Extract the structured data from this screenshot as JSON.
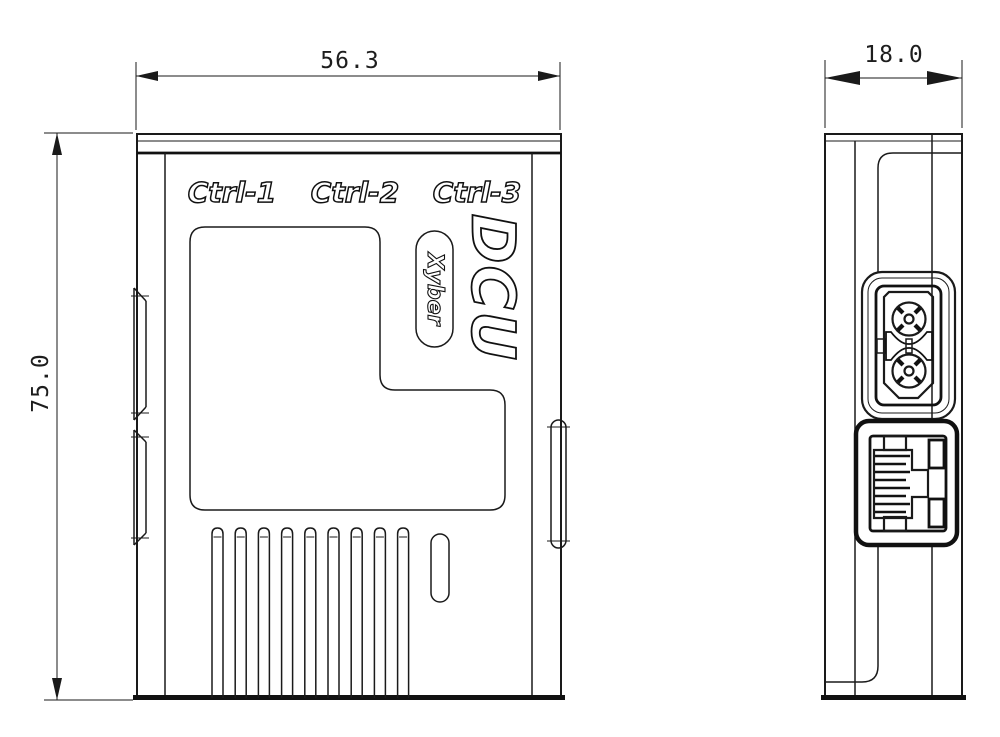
{
  "drawing": {
    "type": "mechanical-dimension-drawing",
    "background_color": "#ffffff",
    "line_color": "#1a1a1a",
    "views": {
      "front": {
        "name": "front-view",
        "width_dimension": "56.3",
        "height_dimension": "75.0",
        "port_labels": {
          "ctrl1": "Ctrl-1",
          "ctrl2": "Ctrl-2",
          "ctrl3": "Ctrl-3"
        },
        "product_logo": "DCU",
        "brand_logo": "Xyber",
        "vent_slot_count": 9,
        "features": [
          "label-recess-panel",
          "side-clip-tabs",
          "vent-slots",
          "led-window"
        ]
      },
      "side": {
        "name": "side-view",
        "depth_dimension": "18.0",
        "features": [
          "xt30-power-connector",
          "rj45-ethernet-port"
        ]
      }
    }
  }
}
